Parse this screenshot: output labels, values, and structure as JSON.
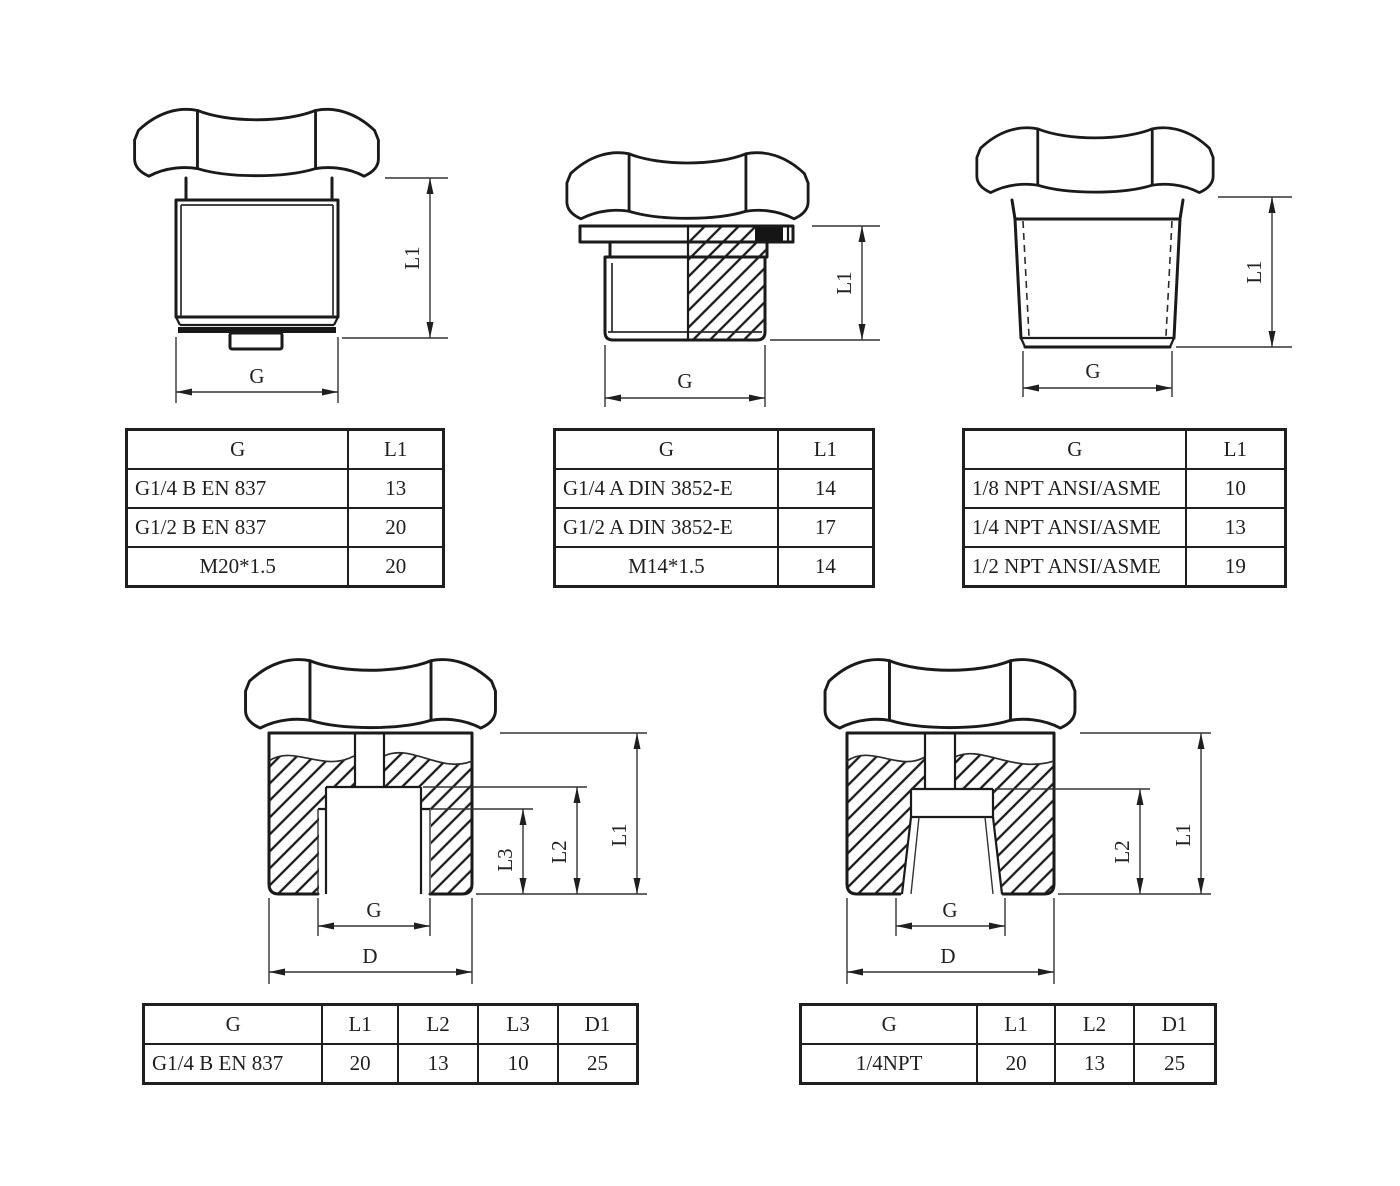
{
  "colors": {
    "line": "#1a1a1a",
    "background": "#ffffff",
    "seal_fill": "#151515"
  },
  "drawings": [
    {
      "name": "parallel-male-thread-en837",
      "dims": {
        "g": "G",
        "l1": "L1"
      }
    },
    {
      "name": "parallel-male-thread-din3852",
      "dims": {
        "g": "G",
        "l1": "L1"
      }
    },
    {
      "name": "taper-male-thread-npt",
      "dims": {
        "g": "G",
        "l1": "L1"
      }
    },
    {
      "name": "female-port-en837",
      "dims": {
        "g": "G",
        "d": "D",
        "l1": "L1",
        "l2": "L2",
        "l3": "L3"
      }
    },
    {
      "name": "female-port-npt",
      "dims": {
        "g": "G",
        "d": "D",
        "l1": "L1",
        "l2": "L2"
      }
    }
  ],
  "tables": [
    {
      "headers": [
        "G",
        "L1"
      ],
      "rows": [
        [
          "G1/4 B EN 837",
          "13"
        ],
        [
          "G1/2 B EN 837",
          "20"
        ],
        [
          "M20*1.5",
          "20"
        ]
      ]
    },
    {
      "headers": [
        "G",
        "L1"
      ],
      "rows": [
        [
          "G1/4 A DIN 3852-E",
          "14"
        ],
        [
          "G1/2 A DIN 3852-E",
          "17"
        ],
        [
          "M14*1.5",
          "14"
        ]
      ]
    },
    {
      "headers": [
        "G",
        "L1"
      ],
      "rows": [
        [
          "1/8 NPT ANSI/ASME",
          "10"
        ],
        [
          "1/4 NPT ANSI/ASME",
          "13"
        ],
        [
          "1/2 NPT ANSI/ASME",
          "19"
        ]
      ]
    },
    {
      "headers": [
        "G",
        "L1",
        "L2",
        "L3",
        "D1"
      ],
      "rows": [
        [
          "G1/4 B EN 837",
          "20",
          "13",
          "10",
          "25"
        ]
      ]
    },
    {
      "headers": [
        "G",
        "L1",
        "L2",
        "D1"
      ],
      "rows": [
        [
          "1/4NPT",
          "20",
          "13",
          "25"
        ]
      ]
    }
  ]
}
